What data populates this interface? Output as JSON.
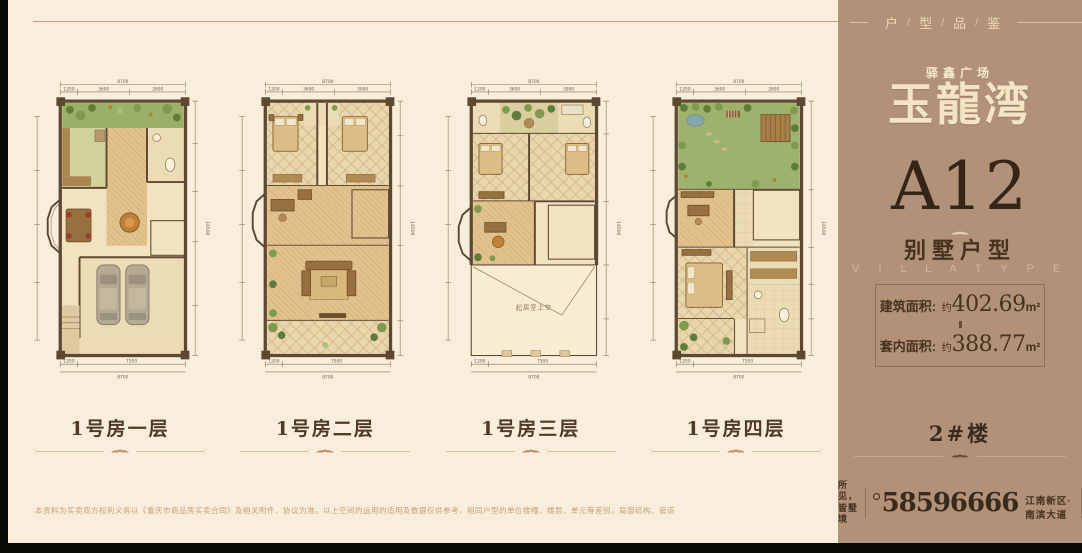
{
  "page": {
    "header_rule_color": "#c89e78",
    "bg_cream": "#f8eedb",
    "bg_panel": "#b29179"
  },
  "plans": {
    "labels": [
      "1号房一层",
      "1号房二层",
      "1号房三层",
      "1号房四层"
    ],
    "void_label": "起居室上空"
  },
  "dims": {
    "top_total": "8700",
    "top_segs": [
      "1200",
      "3600",
      "3900"
    ],
    "bottom_segs": [
      "1200",
      "7500"
    ],
    "bottom_total": "8700",
    "side_total": "16500"
  },
  "panel": {
    "header": {
      "items": [
        "户",
        "型",
        "品",
        "鉴"
      ],
      "sep": "/"
    },
    "brand": {
      "top": "驿鑫广场",
      "main": "玉龍湾"
    },
    "unit": {
      "code": "A12",
      "type_cn": "别墅户型",
      "type_en": "V I L L A   T Y P E"
    },
    "areas": {
      "rows": [
        {
          "label": "建筑面积:",
          "approx": "约",
          "value": "402.69",
          "unit": "m²"
        },
        {
          "label": "套内面积:",
          "approx": "约",
          "value": "388.77",
          "unit": "m²"
        }
      ]
    },
    "building_no": "2#楼",
    "contact": {
      "slogan_line1": "所见，",
      "slogan_line2": "皆墅境",
      "phone": "58596666",
      "address": "江南新区·南滨大道"
    }
  },
  "disclaimer": "本资料为买卖双方权利义务以《重庆市商品房买卖合同》及相关附件、协议为准。以上空间的运用的适用及数据仅供参考，相同户型的单位楼幢、楼层、单元等差别，局部结构、管道、面积等可能不同，最终解释权归开发商所有。"
}
